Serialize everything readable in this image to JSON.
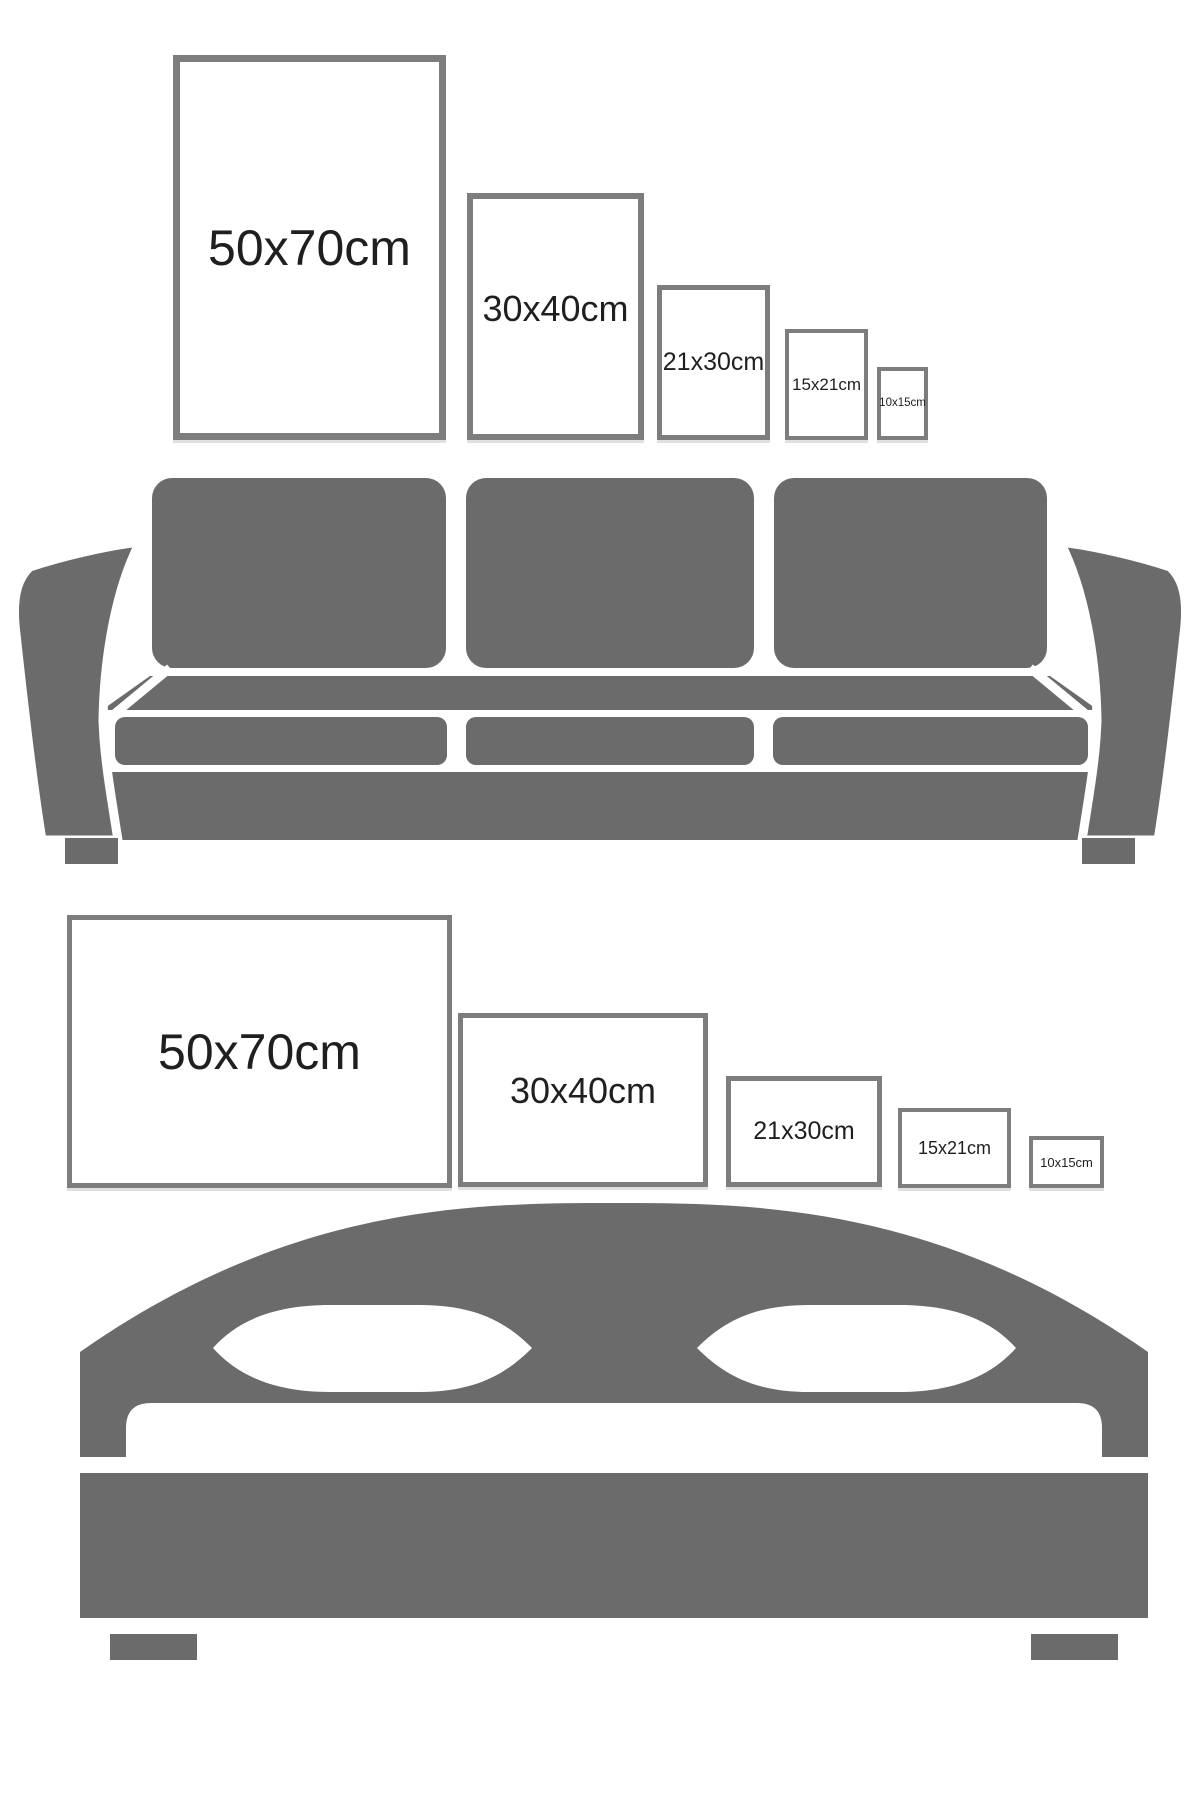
{
  "background": "#ffffff",
  "colors": {
    "furniture_gray": "#6b6b6b",
    "frame_border": "#7d7d7d",
    "label_text": "#1f1f1f"
  },
  "sofa_section": {
    "furniture": "sofa-icon",
    "frames": [
      {
        "label": "50x70cm",
        "orientation": "portrait"
      },
      {
        "label": "30x40cm",
        "orientation": "portrait"
      },
      {
        "label": "21x30cm",
        "orientation": "portrait"
      },
      {
        "label": "15x21cm",
        "orientation": "portrait"
      },
      {
        "label": "10x15cm",
        "orientation": "portrait"
      }
    ]
  },
  "bed_section": {
    "furniture": "bed-icon",
    "frames": [
      {
        "label": "50x70cm",
        "orientation": "landscape"
      },
      {
        "label": "30x40cm",
        "orientation": "landscape"
      },
      {
        "label": "21x30cm",
        "orientation": "landscape"
      },
      {
        "label": "15x21cm",
        "orientation": "landscape"
      },
      {
        "label": "10x15cm",
        "orientation": "landscape"
      }
    ]
  }
}
